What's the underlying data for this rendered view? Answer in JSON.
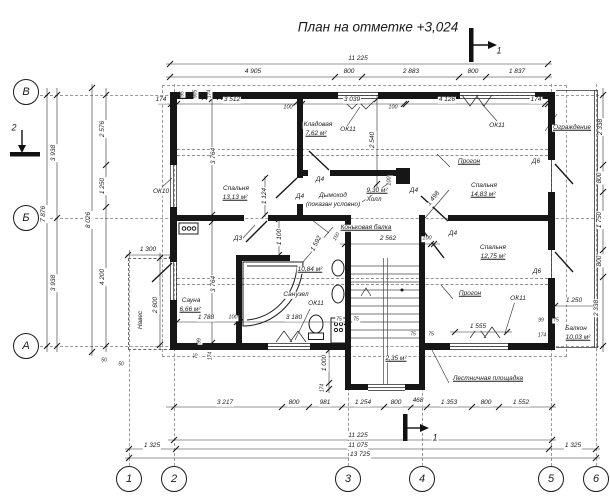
{
  "title": "План на отметке +3,024",
  "axis_grid": {
    "rows": [
      {
        "label": "В",
        "x": 26,
        "y": 92
      },
      {
        "label": "Б",
        "x": 26,
        "y": 218
      },
      {
        "label": "А",
        "x": 26,
        "y": 346
      }
    ],
    "cols": [
      {
        "label": "1",
        "x": 129,
        "y": 479
      },
      {
        "label": "2",
        "x": 174,
        "y": 479
      },
      {
        "label": "3",
        "x": 348,
        "y": 479
      },
      {
        "label": "4",
        "x": 422,
        "y": 479
      },
      {
        "label": "5",
        "x": 551,
        "y": 479
      },
      {
        "label": "6",
        "x": 596,
        "y": 479
      }
    ]
  },
  "annotations": {
    "rooms": [
      {
        "t": "Спальня",
        "x": 236,
        "y": 189
      },
      {
        "t": "13,13 м²",
        "x": 235,
        "y": 198,
        "u": true
      },
      {
        "t": "Кладовая",
        "x": 318,
        "y": 125
      },
      {
        "t": "7,62 м²",
        "x": 316,
        "y": 134,
        "u": true
      },
      {
        "t": "9,30 м²",
        "x": 377,
        "y": 191,
        "u": true
      },
      {
        "t": "Холл",
        "x": 374,
        "y": 200
      },
      {
        "t": "Спальня",
        "x": 484,
        "y": 186
      },
      {
        "t": "14,83 м²",
        "x": 483,
        "y": 195,
        "u": true
      },
      {
        "t": "Спальня",
        "x": 493,
        "y": 248
      },
      {
        "t": "12,75 м²",
        "x": 493,
        "y": 257,
        "u": true
      },
      {
        "t": "Сауна",
        "x": 191,
        "y": 301
      },
      {
        "t": "6,66 м²",
        "x": 190,
        "y": 310,
        "u": true
      },
      {
        "t": "Санузел",
        "x": 296,
        "y": 295
      },
      {
        "t": "10,84 м²",
        "x": 310,
        "y": 270,
        "u": true
      },
      {
        "t": "Балкон",
        "x": 576,
        "y": 329
      },
      {
        "t": "10,03 м²",
        "x": 578,
        "y": 338,
        "u": true
      },
      {
        "t": "Навес",
        "x": 141,
        "y": 320,
        "r": -90
      },
      {
        "t": "2,35 м²",
        "x": 396,
        "y": 359,
        "u": true
      }
    ],
    "openings": [
      {
        "t": "ОК10",
        "x": 161,
        "y": 192
      },
      {
        "t": "ОК11",
        "x": 348,
        "y": 130
      },
      {
        "t": "ОК11",
        "x": 497,
        "y": 126
      },
      {
        "t": "ОК11",
        "x": 316,
        "y": 304
      },
      {
        "t": "ОК11",
        "x": 518,
        "y": 299
      },
      {
        "t": "Д3",
        "x": 238,
        "y": 239
      },
      {
        "t": "Д4",
        "x": 320,
        "y": 180
      },
      {
        "t": "Д4",
        "x": 300,
        "y": 197
      },
      {
        "t": "Д4",
        "x": 414,
        "y": 191
      },
      {
        "t": "Д4",
        "x": 453,
        "y": 234
      },
      {
        "t": "Д6",
        "x": 536,
        "y": 162
      },
      {
        "t": "Д6",
        "x": 537,
        "y": 272
      }
    ],
    "notes": [
      {
        "t": "Прогон",
        "x": 469,
        "y": 162,
        "u": true
      },
      {
        "t": "Прогон",
        "x": 470,
        "y": 294,
        "u": true
      },
      {
        "t": "Коньковая балка",
        "x": 366,
        "y": 228,
        "u": true
      },
      {
        "t": "Дымоход",
        "x": 333,
        "y": 196
      },
      {
        "t": "(показан условно)",
        "x": 333,
        "y": 205
      },
      {
        "t": "Ограждение",
        "x": 572,
        "y": 128,
        "u": true
      },
      {
        "t": "Лестничная площадка",
        "x": 488,
        "y": 379,
        "u": true
      }
    ],
    "section_marks": [
      {
        "t": "1",
        "x": 499,
        "y": 51,
        "fs": 9
      },
      {
        "t": "1",
        "x": 435,
        "y": 438,
        "fs": 9
      },
      {
        "t": "2",
        "x": 14,
        "y": 128,
        "fs": 9
      }
    ],
    "dimensions": [
      {
        "t": "11 225",
        "x": 358,
        "y": 59
      },
      {
        "t": "4 905",
        "x": 253,
        "y": 72
      },
      {
        "t": "800",
        "x": 349,
        "y": 72
      },
      {
        "t": "2 883",
        "x": 411,
        "y": 72
      },
      {
        "t": "800",
        "x": 473,
        "y": 72
      },
      {
        "t": "1 837",
        "x": 517,
        "y": 72
      },
      {
        "t": "174",
        "x": 161,
        "y": 100
      },
      {
        "t": "3 512",
        "x": 232,
        "y": 100
      },
      {
        "t": "100",
        "x": 288,
        "y": 108,
        "fs": 5.5
      },
      {
        "t": "3 039",
        "x": 352,
        "y": 100
      },
      {
        "t": "100",
        "x": 393,
        "y": 108,
        "fs": 5.5
      },
      {
        "t": "4 126",
        "x": 447,
        "y": 100
      },
      {
        "t": "174",
        "x": 536,
        "y": 100
      },
      {
        "t": "95",
        "x": 183,
        "y": 94,
        "r": -90,
        "fs": 5
      },
      {
        "t": "905",
        "x": 196,
        "y": 94,
        "r": -90,
        "fs": 5
      },
      {
        "t": "174",
        "x": 210,
        "y": 94,
        "r": -90,
        "fs": 5
      },
      {
        "t": "7 876",
        "x": 44,
        "y": 214,
        "r": -90
      },
      {
        "t": "3 938",
        "x": 54,
        "y": 153,
        "r": -90
      },
      {
        "t": "3 938",
        "x": 54,
        "y": 283,
        "r": -90
      },
      {
        "t": "8 026",
        "x": 89,
        "y": 220,
        "r": -90
      },
      {
        "t": "2 576",
        "x": 103,
        "y": 129,
        "r": -90
      },
      {
        "t": "1 250",
        "x": 103,
        "y": 186,
        "r": -90
      },
      {
        "t": "4 200",
        "x": 103,
        "y": 277,
        "r": -90
      },
      {
        "t": "1 300",
        "x": 148,
        "y": 250
      },
      {
        "t": "2 600",
        "x": 156,
        "y": 305,
        "r": -90
      },
      {
        "t": "50",
        "x": 104,
        "y": 361,
        "fs": 5
      },
      {
        "t": "50",
        "x": 121,
        "y": 365,
        "fs": 5
      },
      {
        "t": "2 338",
        "x": 601,
        "y": 127,
        "r": -90
      },
      {
        "t": "800",
        "x": 600,
        "y": 178,
        "r": -90
      },
      {
        "t": "1 750",
        "x": 600,
        "y": 220,
        "r": -90
      },
      {
        "t": "800",
        "x": 600,
        "y": 261,
        "r": -90
      },
      {
        "t": "2 338",
        "x": 597,
        "y": 308,
        "r": -90
      },
      {
        "t": "1 250",
        "x": 574,
        "y": 301
      },
      {
        "t": "99",
        "x": 541,
        "y": 321,
        "fs": 5
      },
      {
        "t": "75",
        "x": 556,
        "y": 321,
        "fs": 5
      },
      {
        "t": "174",
        "x": 542,
        "y": 336,
        "fs": 5
      },
      {
        "t": "3 217",
        "x": 225,
        "y": 403
      },
      {
        "t": "800",
        "x": 294,
        "y": 403
      },
      {
        "t": "981",
        "x": 325,
        "y": 403
      },
      {
        "t": "1 254",
        "x": 363,
        "y": 403
      },
      {
        "t": "800",
        "x": 396,
        "y": 403
      },
      {
        "t": "468",
        "x": 418,
        "y": 401
      },
      {
        "t": "1 353",
        "x": 449,
        "y": 403
      },
      {
        "t": "800",
        "x": 486,
        "y": 403
      },
      {
        "t": "1 552",
        "x": 521,
        "y": 403
      },
      {
        "t": "11 225",
        "x": 358,
        "y": 436
      },
      {
        "t": "1 325",
        "x": 152,
        "y": 446
      },
      {
        "t": "11 075",
        "x": 358,
        "y": 446
      },
      {
        "t": "1 325",
        "x": 573,
        "y": 446
      },
      {
        "t": "13 725",
        "x": 360,
        "y": 455
      },
      {
        "t": "99",
        "x": 200,
        "y": 341,
        "r": -90,
        "fs": 5
      },
      {
        "t": "75",
        "x": 197,
        "y": 356,
        "r": -90,
        "fs": 5
      },
      {
        "t": "174",
        "x": 211,
        "y": 356,
        "r": -90,
        "fs": 5
      },
      {
        "t": "75",
        "x": 339,
        "y": 320,
        "fs": 5
      },
      {
        "t": "75",
        "x": 356,
        "y": 320,
        "fs": 5
      },
      {
        "t": "75",
        "x": 413,
        "y": 335,
        "fs": 5
      },
      {
        "t": "75",
        "x": 431,
        "y": 335,
        "fs": 5
      },
      {
        "t": "1 000",
        "x": 325,
        "y": 363,
        "r": -90
      },
      {
        "t": "174",
        "x": 323,
        "y": 388,
        "r": -90,
        "fs": 5
      },
      {
        "t": "1 555",
        "x": 478,
        "y": 327
      },
      {
        "t": "3 764",
        "x": 214,
        "y": 156,
        "r": -90
      },
      {
        "t": "3 764",
        "x": 214,
        "y": 284,
        "r": -90
      },
      {
        "t": "1 124",
        "x": 265,
        "y": 196,
        "r": -90
      },
      {
        "t": "2 540",
        "x": 373,
        "y": 140,
        "r": -90
      },
      {
        "t": "2 562",
        "x": 388,
        "y": 239
      },
      {
        "t": "100",
        "x": 427,
        "y": 239,
        "fs": 5.5
      },
      {
        "t": "1 498",
        "x": 434,
        "y": 199,
        "r": -52
      },
      {
        "t": "1 592",
        "x": 317,
        "y": 244,
        "r": -62
      },
      {
        "t": "150",
        "x": 337,
        "y": 237,
        "r": -62,
        "fs": 5
      },
      {
        "t": "1 100",
        "x": 280,
        "y": 237,
        "r": -90
      },
      {
        "t": "1 788",
        "x": 206,
        "y": 318
      },
      {
        "t": "100",
        "x": 233,
        "y": 318,
        "fs": 5.5
      },
      {
        "t": "3 180",
        "x": 294,
        "y": 318
      },
      {
        "t": "100",
        "x": 390,
        "y": 181,
        "r": -90,
        "fs": 5.5
      }
    ]
  }
}
